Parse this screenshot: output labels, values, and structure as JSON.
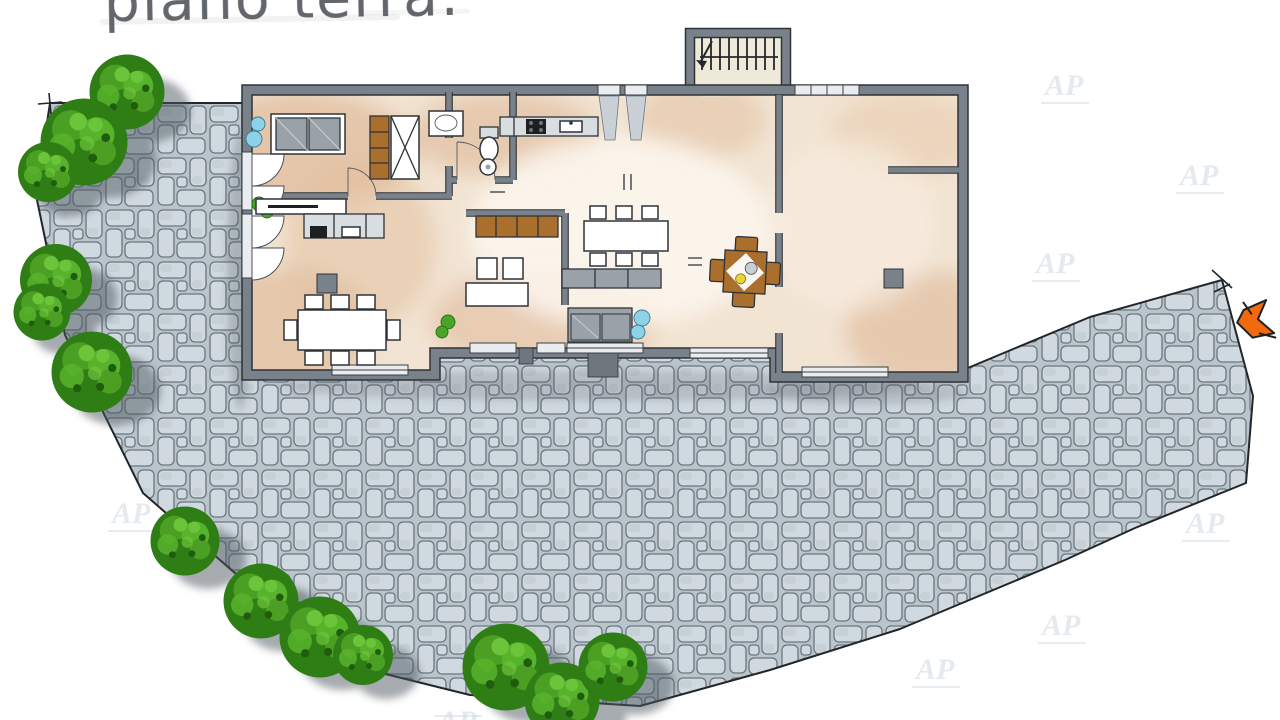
{
  "page": {
    "background": "#ffffff",
    "width": 1280,
    "height": 720
  },
  "title": {
    "text": "piano terra:",
    "color": "#63676b"
  },
  "watermark": {
    "text": "AP",
    "color": "#ccd6de"
  },
  "plan": {
    "colors": {
      "wall": "#79828a",
      "wall_edge": "#2f3338",
      "floor_base": "#f2e4d3",
      "floor_warm": "#ddb593",
      "floor_light": "#fdf7ee",
      "stair_floor": "#efe9da",
      "paving_stone": "#d0d9df",
      "paving_joint": "#b9c4cb",
      "paving_outline": "#6b7680",
      "boundary_line": "#22262a",
      "tree_green": "#2f7d15",
      "shadow": "#4d565e",
      "wood": "#aa6e2d",
      "furniture_gray": "#9aa2a9",
      "plant_blue": "#8ed2ea",
      "plant_green": "#47a62a",
      "arrow_orange": "#f26a0e"
    },
    "entrance_arrow": {
      "direction": "left"
    }
  }
}
